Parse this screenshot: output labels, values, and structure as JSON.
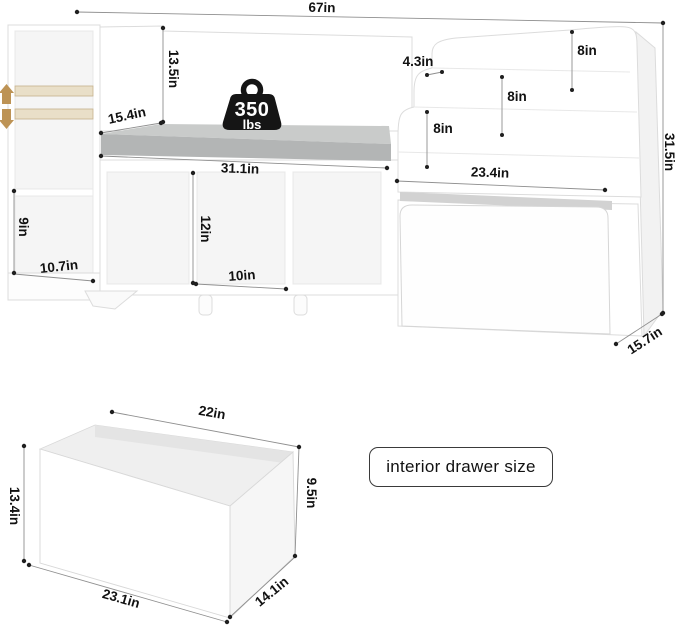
{
  "main_unit": {
    "labels": {
      "width": "67in",
      "backrest_height": "13.5in",
      "seat_depth": "15.4in",
      "seat_width": "31.1in",
      "left_shelf_height": "9in",
      "left_depth": "10.7in",
      "cubby_height": "12in",
      "cubby_width": "10in",
      "shelf_lip": "4.3in",
      "shelf_gap_1": "8in",
      "shelf_gap_2": "8in",
      "shelf_gap_3": "8in",
      "right_width": "23.4in",
      "total_height": "31.5in",
      "depth": "15.7in"
    },
    "weight_badge": {
      "value": "350",
      "unit": "lbs"
    }
  },
  "drawer_figure": {
    "caption": "interior drawer size",
    "labels": {
      "top_width": "22in",
      "front_height": "13.4in",
      "back_height": "9.5in",
      "bottom_width": "23.1in",
      "side_depth": "14.1in"
    }
  },
  "colors": {
    "cushion_top": "#c9cbca",
    "cushion_front": "#b3b5b5",
    "shelf_beige": "#e9dfc8",
    "shelf_beige_edge": "#c6b28c",
    "arrow_tan": "#bd9355",
    "badge_black": "#151515",
    "slot_gray": "#d2d2d2",
    "dim_line": "#8f8f8f",
    "dot": "#1f1f1f"
  }
}
